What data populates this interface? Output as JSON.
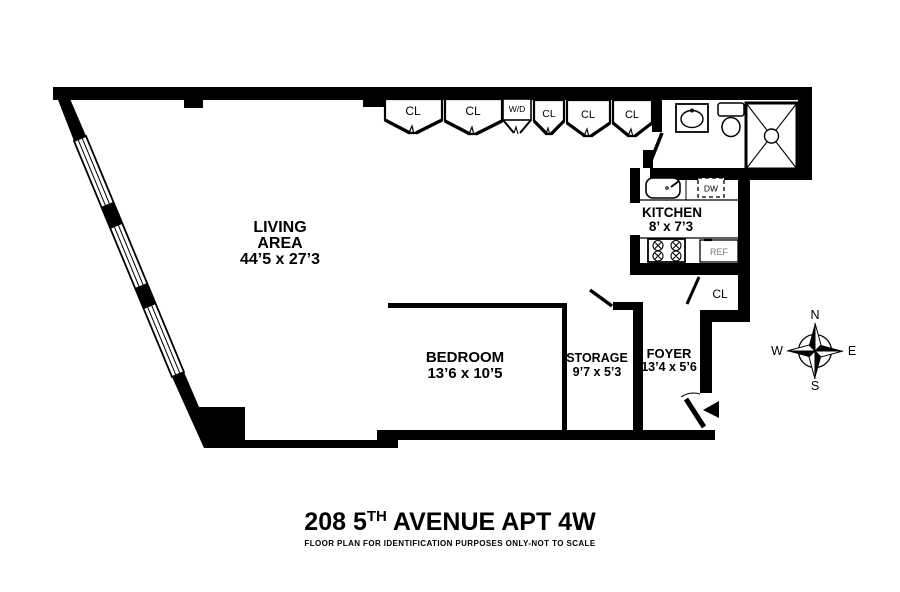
{
  "floor_plan": {
    "rooms": {
      "living": {
        "line1": "LIVING",
        "line2": "AREA",
        "dims": "44’5 x 27’3"
      },
      "bedroom": {
        "name": "BEDROOM",
        "dims": "13’6 x 10’5"
      },
      "storage": {
        "name": "STORAGE",
        "dims": "9’7 x 5’3"
      },
      "foyer": {
        "name": "FOYER",
        "dims": "13’4 x 5’6"
      },
      "kitchen": {
        "name": "KITCHEN",
        "dims": "8’ x 7’3"
      }
    },
    "closets": {
      "top_row": [
        "CL",
        "CL",
        "W/D",
        "CL",
        "CL",
        "CL"
      ],
      "hall": "CL"
    },
    "appliances": {
      "dishwasher": "DW",
      "refrigerator": "REF"
    },
    "compass": {
      "n": "N",
      "s": "S",
      "e": "E",
      "w": "W"
    }
  },
  "footer": {
    "title_prefix": "208 5",
    "title_sup": "TH",
    "title_suffix": " AVENUE APT 4W",
    "disclaimer": "FLOOR PLAN FOR IDENTIFICATION PURPOSES ONLY-NOT TO SCALE"
  },
  "colors": {
    "wall": "#000000",
    "background": "#ffffff",
    "ref_text": "#777777"
  }
}
